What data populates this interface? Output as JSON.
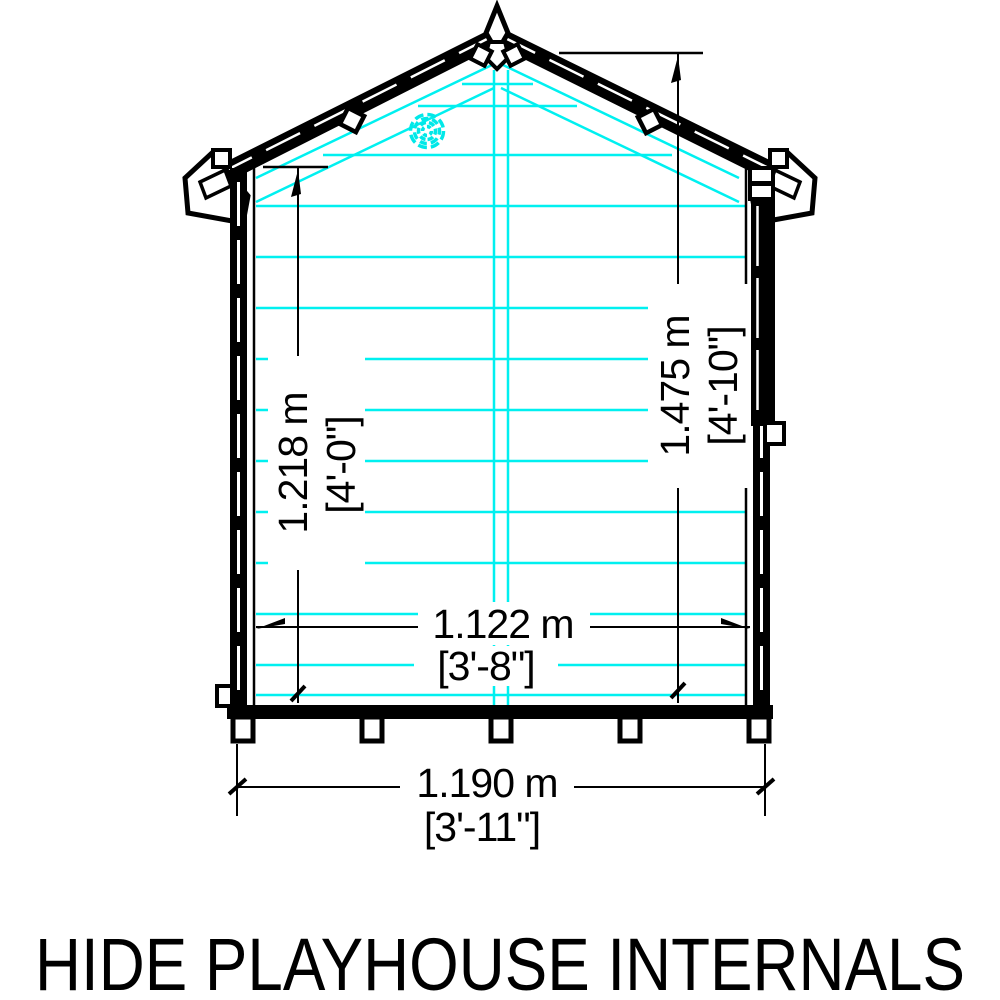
{
  "title": "HIDE PLAYHOUSE INTERNALS",
  "drawing": {
    "type": "playhouse-front-elevation-internal-dimensions",
    "colors": {
      "outline": "#000000",
      "cladding_lines": "#00f0f0",
      "knot_mark": "#00e8e8",
      "background": "#ffffff"
    }
  },
  "dimensions": {
    "eaves_height": {
      "metric": "1.218 m",
      "imperial": "[4'-0\"]"
    },
    "ridge_height": {
      "metric": "1.475 m",
      "imperial": "[4'-10\"]"
    },
    "internal_width": {
      "metric": "1.122 m",
      "imperial": "[3'-8\"]"
    },
    "base_width": {
      "metric": "1.190 m",
      "imperial": "[3'-11\"]"
    }
  }
}
